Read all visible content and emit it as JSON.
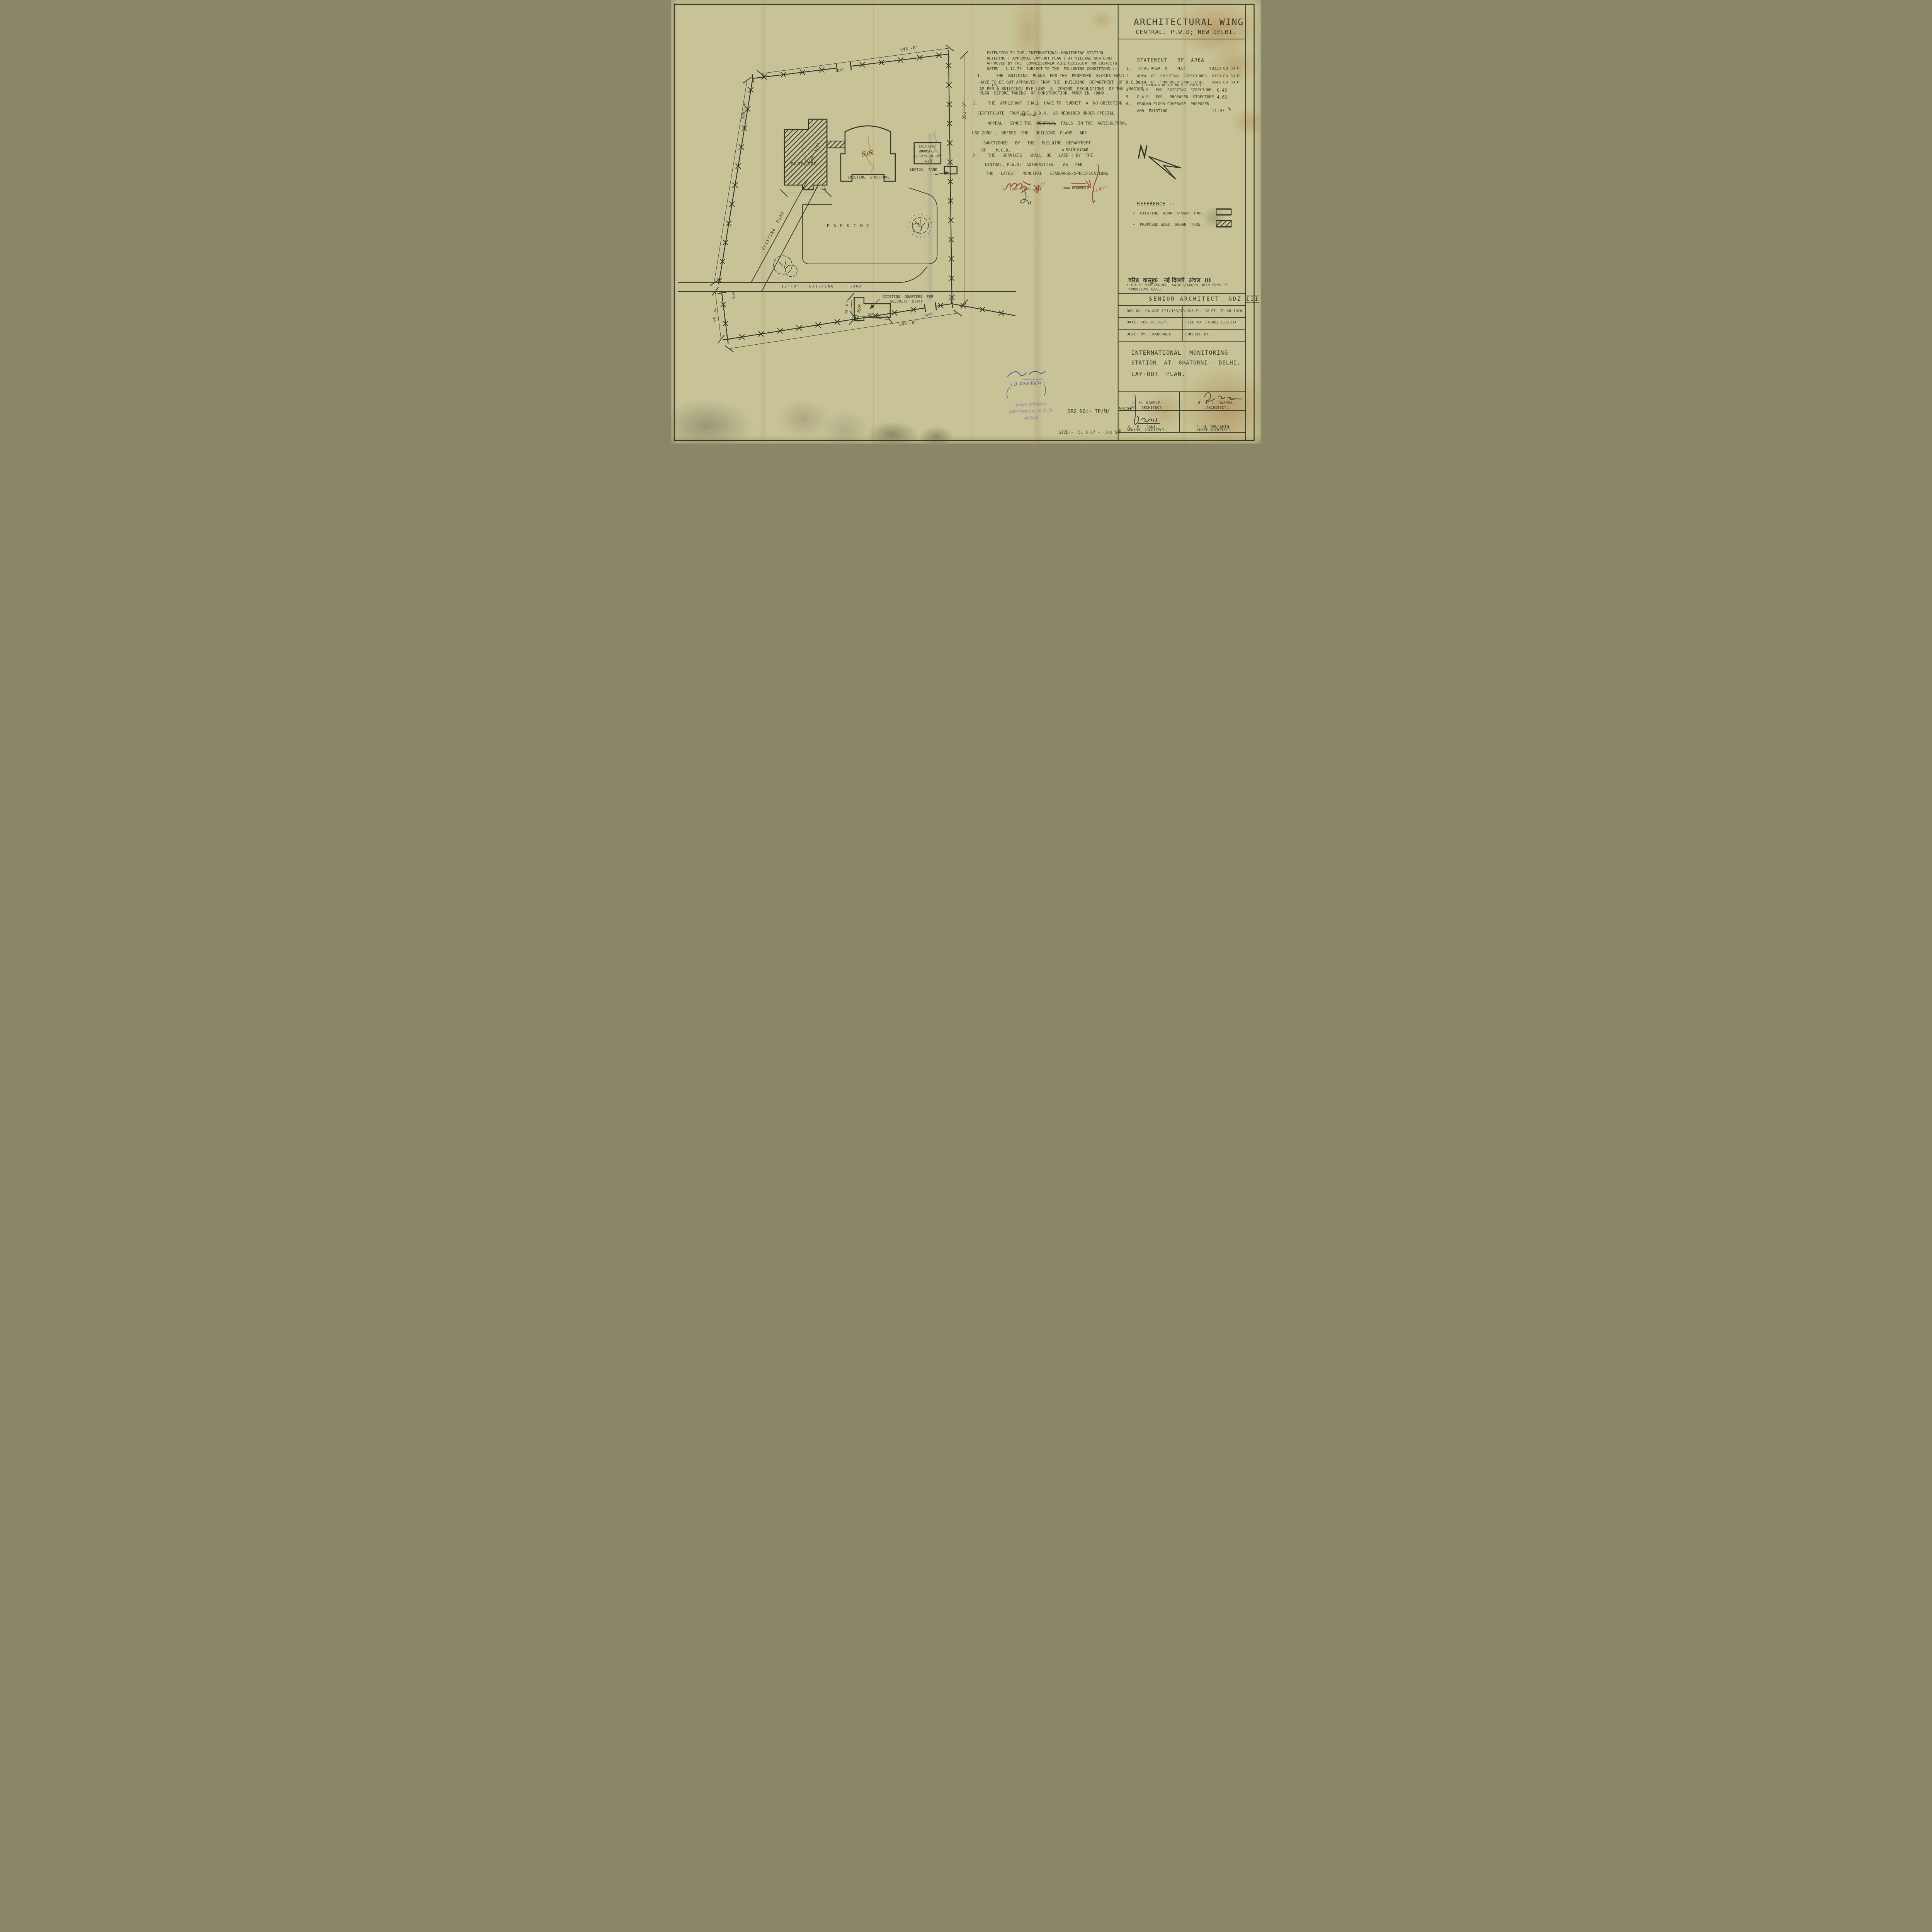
{
  "header": {
    "line1": "ARCHITECTURAL WING",
    "line2": "CENTRAL. P.W.D; NEW DELHI."
  },
  "notes": {
    "intro": [
      "EXTENSION TO THE  INTERNATIONAL MONITORING STATION",
      "BUILDING ( APPROVAL LAY-OUT PLAN ) AT VILLAGE GHATORNI",
      "APPROVED BY THE  COMMISSIONER VIDE DECISION  NO 1024/STG.",
      "DATED . 1.12.76  SUBJECT TO THE  FOLLOWING CONDITIONS :-"
    ],
    "c1": {
      "no": "1.",
      "l1": "THE  BUILDING  PLANS  FOR THE  PROPOSED  BLOCKS SHALL",
      "l2": "HAVE TO BE GOT APPROVED  FROM THE  BUILDING  DEPARTMENT  OF M.C.D;",
      "l3": "AS PER A BUILDING/ BYE-LAWS  &  ZONING  REGULATIONS  OF THE  MASTER",
      "l3_ins": "THE",
      "l4": "PLAN  BEFORE TAKING  UP CONSTRUCTION  WORK IN  HAND ."
    },
    "c2": {
      "no": "2.",
      "l1": "THE  APPLICANT  SHALL  HAVE TO  SUBMIT  A  NO OBJECTION",
      "l2": "CERTIFICATE  FROM THE  D.D.A.  AS REQUIRED UNDER SPECIAL",
      "l3_pre": "APPEAL , SINCE THE  ",
      "l3_struck": "PERPOSAL",
      "l3_ins": "PROPOSAL",
      "l3_post": "  FALLS  IN THE  AGRICULTURAL",
      "l4": "USE ZONE ,  BEFORE  THE   BUILDING  PLANS   ARE",
      "l5": "SANCTIONED   BY   THE   BUILDING  DEPARTMEMT",
      "l6": "OF    M.C.D."
    },
    "c3": {
      "no": "3.",
      "l1": "THE   SERVICES   SHALL  BE   LAID ↑ BY  THE",
      "l1_ins": "& MAINTAINED",
      "l2": "CENTRAL. P.W.D;  AUTHORITIES    AS   PER",
      "l3": "THE   LATEST   MUNCIPAL   STANDARDS/SPECIFICATIONS"
    }
  },
  "statement": {
    "title": "STATEMENT   OF  AREA .",
    "rows": [
      {
        "no": "1.",
        "item": "TOTAL AREA  OF   PLOT.",
        "value": "98332.00",
        "unit": "SQ.FT."
      },
      {
        "no": "2",
        "item": "AREA  OF  EXISTING  STRECTURES",
        "value": "6339.00",
        "unit": "SQ.FT."
      },
      {
        "no": "3",
        "item": "AREA  OF  PROPOSED STRECTURE.",
        "item2": "(EXTENSION OF THE MAIN BUILDING)",
        "value": "4545.00",
        "unit": "SQ.FT."
      },
      {
        "no": "4",
        "item": "F.A.R   FOR  EXISTING  STRECTURE.",
        "value": "6.45",
        "unit": ""
      },
      {
        "no": "5",
        "item": "F.A.R   FOR   PROPOSED  STRECTURE.",
        "value": "4.62",
        "unit": ""
      },
      {
        "no": "6.",
        "item": "GROUND FLOOR COVERAGE  PROPOSED",
        "item2": "AND  EXISTING",
        "value": "11.07",
        "unit": "%"
      }
    ]
  },
  "reference": {
    "title": "REFERENCE :-",
    "existing": "•  EXISTING  WORK  SHOWN  THUS .",
    "proposed": "•  PROPOSED WORK  SHOWN  THUS ."
  },
  "plan": {
    "dim_248": "248'-0\"",
    "dim_288": "288'-0\"",
    "dim_351": "351'-0\"",
    "dim_305": "305'-0\"",
    "dim_65": "65'-0\"",
    "dim_57": "57'-1½\"",
    "dim_85": "85'-1/2\"",
    "dim_23": "23'-0\"",
    "dim_50": "50'-0\"",
    "gate": "GATE",
    "road12": "12'-0\"   EXISTING     ROAD",
    "existing_road": "EXISTING  ROAD",
    "parking": "P A R K I N G",
    "proposed": "PROPOSED",
    "existing_structure": "EXISTING  STRECTURE",
    "workshop1": "EXISTING",
    "workshop2": "WORKSHOP",
    "workshop3": "35'-0\"X 29'-0\"",
    "septic": "SEPTIC  TANK",
    "quarters1": "EXISTING  QUARTERS  FOR",
    "quarters2": "SECURITY  STAFF.",
    "ss": "S/S"
  },
  "annotations": {
    "jr_label": "JR. TOWN PLANNER (L)",
    "jr_date": "29/6/77",
    "tp_label": "TOWN PLANNER",
    "tp_date": "11-8-77",
    "keswani": "( B. KESWANI )",
    "stamp1": "स्थापत्य अभियन्ता-१",
    "stamp2": "अधीन मण्डल-१ के. लो. नि. वि.",
    "stamp3": "नई दिल्ली",
    "drg_hw1": "DRG NO:- TP/M/",
    "drg_hw2": "5520",
    "size_hw1": "SIZE:- ·51 X·67 = ·341 SQ",
    "size_hw2": "m."
  },
  "title_block": {
    "hindi": "वरिष्ठ  वास्तुक   नई दिल्ली  अंचल  III",
    "traced1": "• TRACED FROM DRG.NO.  SA(A)1/333/7R, WITH TERMS OF",
    "traced2": "CONDITIONS ADDED.",
    "senior": "SENIOR ARCHITECT  NDZ ",
    "roman": "III",
    "drg_no": "DRG.NO. SA-NDZ III/333/7R₂",
    "scale": "SCALE:- 32 FT. TO AN INCH.",
    "date": "DATE: FEB.28.1977.",
    "file_no": "FILE NO  SA-NDZ III/333",
    "dealt_by": "DEALT BY.  KAUSHALA.",
    "checked_by": "CHECKED BY.",
    "title1": "INTERNATIONAL  MONITORING",
    "title2": "STATION  AT  GHATORNI - DELHI.",
    "title3": "LAY-OUT  PLAN.",
    "sig": [
      {
        "name": "V. H. KAMBLE.",
        "role": "DY.  ARCHITECT"
      },
      {
        "name": "M. M. L. SHARMA.",
        "role": "ARCHITECT."
      },
      {
        "name": "K.  R.  JANI.",
        "role": "SENIOR  ARCHITECT."
      },
      {
        "name": "J. M. BENJAMIN.",
        "role": "CHIEF ARCHITECT."
      }
    ]
  }
}
